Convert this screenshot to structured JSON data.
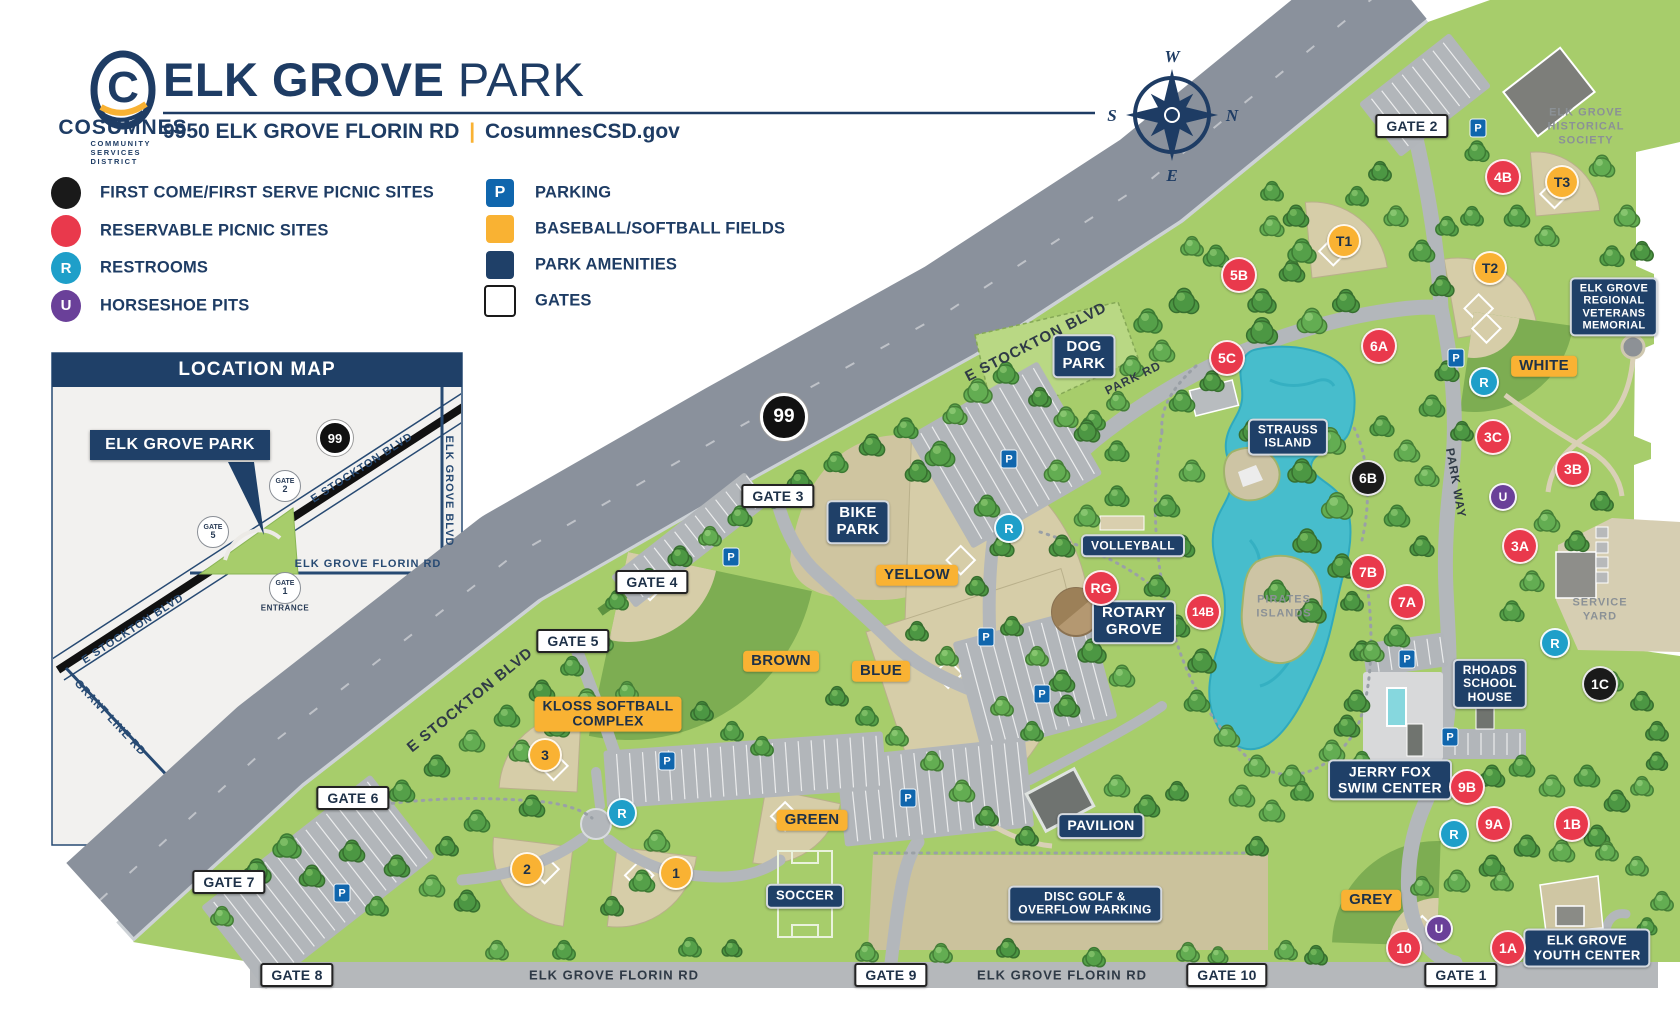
{
  "header": {
    "org": "COSUMNES",
    "org_sub": "COMMUNITY SERVICES DISTRICT",
    "logo_letter": "C",
    "title_bold": "ELK GROVE",
    "title_light": "PARK",
    "address": "9950 ELK GROVE FLORIN RD",
    "separator": "|",
    "website": "CosumnesCSD.gov"
  },
  "compass": {
    "top": "W",
    "right": "N",
    "bottom": "E",
    "left": "S"
  },
  "legend": {
    "left": [
      {
        "icon": "black-circle",
        "glyph": "",
        "label": "FIRST COME/FIRST SERVE PICNIC SITES"
      },
      {
        "icon": "red-circle",
        "glyph": "",
        "label": "RESERVABLE PICNIC SITES"
      },
      {
        "icon": "restroom-circle",
        "glyph": "R",
        "label": "RESTROOMS"
      },
      {
        "icon": "horseshoe-circle",
        "glyph": "U",
        "label": "HORSESHOE PITS"
      }
    ],
    "right": [
      {
        "icon": "parking-square",
        "glyph": "P",
        "label": "PARKING"
      },
      {
        "icon": "yellow-square",
        "glyph": "",
        "label": "BASEBALL/SOFTBALL FIELDS"
      },
      {
        "icon": "navy-square",
        "glyph": "",
        "label": "PARK AMENITIES"
      },
      {
        "icon": "white-square",
        "glyph": "",
        "label": "GATES"
      }
    ]
  },
  "location_map": {
    "title": "LOCATION MAP",
    "park_label": "ELK GROVE PARK",
    "highway": "99",
    "entrance": "ENTRANCE",
    "gates": [
      {
        "line1": "GATE",
        "line2": "2",
        "x": 285,
        "y": 486
      },
      {
        "line1": "GATE",
        "line2": "5",
        "x": 213,
        "y": 532
      },
      {
        "line1": "GATE",
        "line2": "1",
        "x": 285,
        "y": 588
      }
    ],
    "road_labels": [
      {
        "text": "E STOCKTON BLVD",
        "x": 362,
        "y": 468,
        "rot": -33,
        "fs": 11
      },
      {
        "text": "E STOCKTON BLVD",
        "x": 133,
        "y": 629,
        "rot": -33,
        "fs": 11
      },
      {
        "text": "ELK GROVE FLORIN RD",
        "x": 368,
        "y": 564,
        "rot": 0,
        "fs": 11
      },
      {
        "text": "ELK GROVE BLVD",
        "x": 449,
        "y": 491,
        "rot": 90,
        "fs": 11
      },
      {
        "text": "GRANT LINE RD",
        "x": 110,
        "y": 718,
        "rot": 47,
        "fs": 11
      }
    ]
  },
  "map": {
    "highway_badge": {
      "text": "99",
      "x": 784,
      "y": 417
    },
    "gates": [
      {
        "label": "GATE 1",
        "x": 1461,
        "y": 975
      },
      {
        "label": "GATE 2",
        "x": 1412,
        "y": 126
      },
      {
        "label": "GATE 3",
        "x": 778,
        "y": 496
      },
      {
        "label": "GATE 4",
        "x": 652,
        "y": 582
      },
      {
        "label": "GATE 5",
        "x": 573,
        "y": 641
      },
      {
        "label": "GATE 6",
        "x": 353,
        "y": 798
      },
      {
        "label": "GATE 7",
        "x": 229,
        "y": 882
      },
      {
        "label": "GATE 8",
        "x": 297,
        "y": 975
      },
      {
        "label": "GATE 9",
        "x": 891,
        "y": 975
      },
      {
        "label": "GATE 10",
        "x": 1227,
        "y": 975
      }
    ],
    "amenities": [
      {
        "id": "dog-park",
        "lines": [
          "DOG",
          "PARK"
        ],
        "x": 1084,
        "y": 356,
        "fs": 15
      },
      {
        "id": "bike-park",
        "lines": [
          "BIKE",
          "PARK"
        ],
        "x": 858,
        "y": 522,
        "fs": 15
      },
      {
        "id": "volleyball",
        "lines": [
          "VOLLEYBALL"
        ],
        "x": 1133,
        "y": 546,
        "fs": 12
      },
      {
        "id": "rotary-grove",
        "lines": [
          "ROTARY",
          "GROVE"
        ],
        "x": 1134,
        "y": 622,
        "fs": 15
      },
      {
        "id": "strauss-island",
        "lines": [
          "STRAUSS",
          "ISLAND"
        ],
        "x": 1288,
        "y": 437,
        "fs": 12
      },
      {
        "id": "pavilion",
        "lines": [
          "PAVILION"
        ],
        "x": 1101,
        "y": 826,
        "fs": 14
      },
      {
        "id": "disc-golf",
        "lines": [
          "DISC GOLF &",
          "OVERFLOW PARKING"
        ],
        "x": 1085,
        "y": 904,
        "fs": 12
      },
      {
        "id": "jerry-fox-swim-center",
        "lines": [
          "JERRY FOX",
          "SWIM CENTER"
        ],
        "x": 1390,
        "y": 780,
        "fs": 14
      },
      {
        "id": "rhoads-school-house",
        "lines": [
          "RHOADS",
          "SCHOOL",
          "HOUSE"
        ],
        "x": 1490,
        "y": 684,
        "fs": 12
      },
      {
        "id": "elk-grove-youth-center",
        "lines": [
          "ELK GROVE",
          "YOUTH CENTER"
        ],
        "x": 1587,
        "y": 948,
        "fs": 13
      },
      {
        "id": "veterans-memorial",
        "lines": [
          "ELK GROVE",
          "REGIONAL",
          "VETERANS",
          "MEMORIAL"
        ],
        "x": 1614,
        "y": 307,
        "fs": 11
      },
      {
        "id": "soccer",
        "lines": [
          "SOCCER"
        ],
        "x": 805,
        "y": 896,
        "fs": 13
      }
    ],
    "field_labels": [
      {
        "label": "WHITE",
        "x": 1544,
        "y": 366
      },
      {
        "label": "YELLOW",
        "x": 917,
        "y": 575
      },
      {
        "label": "BROWN",
        "x": 781,
        "y": 661
      },
      {
        "label": "BLUE",
        "x": 881,
        "y": 671
      },
      {
        "label": "GREEN",
        "x": 812,
        "y": 820
      },
      {
        "label": "GREY",
        "x": 1371,
        "y": 900
      }
    ],
    "kloss_label": {
      "lines": [
        "KLOSS SOFTBALL",
        "COMPLEX"
      ],
      "x": 608,
      "y": 714
    },
    "reservable_sites": [
      {
        "label": "4B",
        "x": 1503,
        "y": 177
      },
      {
        "label": "5B",
        "x": 1239,
        "y": 275
      },
      {
        "label": "6A",
        "x": 1379,
        "y": 346
      },
      {
        "label": "5C",
        "x": 1227,
        "y": 358
      },
      {
        "label": "3C",
        "x": 1493,
        "y": 437
      },
      {
        "label": "3B",
        "x": 1573,
        "y": 469
      },
      {
        "label": "3A",
        "x": 1520,
        "y": 546
      },
      {
        "label": "7B",
        "x": 1368,
        "y": 572
      },
      {
        "label": "RG",
        "x": 1101,
        "y": 588
      },
      {
        "label": "7A",
        "x": 1407,
        "y": 602
      },
      {
        "label": "14B",
        "x": 1203,
        "y": 612
      },
      {
        "label": "9B",
        "x": 1467,
        "y": 787
      },
      {
        "label": "9A",
        "x": 1494,
        "y": 824
      },
      {
        "label": "1B",
        "x": 1572,
        "y": 824
      },
      {
        "label": "10",
        "x": 1404,
        "y": 948
      },
      {
        "label": "1A",
        "x": 1508,
        "y": 948
      }
    ],
    "first_come_sites": [
      {
        "label": "6B",
        "x": 1368,
        "y": 478
      },
      {
        "label": "1C",
        "x": 1600,
        "y": 684
      }
    ],
    "field_markers": [
      {
        "label": "T3",
        "x": 1562,
        "y": 182
      },
      {
        "label": "T1",
        "x": 1344,
        "y": 241
      },
      {
        "label": "T2",
        "x": 1490,
        "y": 268
      },
      {
        "label": "3",
        "x": 545,
        "y": 755
      },
      {
        "label": "2",
        "x": 527,
        "y": 869
      },
      {
        "label": "1",
        "x": 676,
        "y": 873
      }
    ],
    "restrooms": [
      {
        "x": 1484,
        "y": 382
      },
      {
        "x": 1009,
        "y": 528
      },
      {
        "x": 622,
        "y": 813
      },
      {
        "x": 1555,
        "y": 643
      },
      {
        "x": 1454,
        "y": 834
      }
    ],
    "horseshoe_pits": [
      {
        "x": 1503,
        "y": 497
      },
      {
        "x": 1439,
        "y": 929
      }
    ],
    "parking": [
      {
        "x": 1478,
        "y": 128
      },
      {
        "x": 1456,
        "y": 358
      },
      {
        "x": 1009,
        "y": 459
      },
      {
        "x": 731,
        "y": 557
      },
      {
        "x": 986,
        "y": 637
      },
      {
        "x": 1042,
        "y": 694
      },
      {
        "x": 667,
        "y": 761
      },
      {
        "x": 342,
        "y": 893
      },
      {
        "x": 908,
        "y": 798
      },
      {
        "x": 1407,
        "y": 659
      },
      {
        "x": 1450,
        "y": 737
      }
    ],
    "road_labels": [
      {
        "text": "E STOCKTON BLVD",
        "x": 1036,
        "y": 342,
        "rot": -27,
        "fs": 15
      },
      {
        "text": "E STOCKTON BLVD",
        "x": 470,
        "y": 700,
        "rot": -39,
        "fs": 15
      },
      {
        "text": "PARK RD",
        "x": 1133,
        "y": 378,
        "rot": -26,
        "fs": 12
      },
      {
        "text": "PARK WAY",
        "x": 1456,
        "y": 483,
        "rot": 80,
        "fs": 12
      },
      {
        "text": "ELK GROVE FLORIN RD",
        "x": 614,
        "y": 975,
        "rot": 0,
        "fs": 13
      },
      {
        "text": "ELK GROVE FLORIN RD",
        "x": 1062,
        "y": 975,
        "rot": 0,
        "fs": 13
      }
    ],
    "annotations": [
      {
        "id": "historical-society",
        "lines": [
          "ELK GROVE",
          "HISTORICAL",
          "SOCIETY"
        ],
        "x": 1586,
        "y": 127,
        "fs": 11
      },
      {
        "id": "service-yard",
        "lines": [
          "SERVICE",
          "YARD"
        ],
        "x": 1600,
        "y": 610,
        "fs": 11
      },
      {
        "id": "pirates-islands",
        "lines": [
          "PIRATES",
          "ISLANDS"
        ],
        "x": 1284,
        "y": 607,
        "fs": 11
      }
    ]
  },
  "colors": {
    "navy": "#1f4068",
    "navy_text": "#1e3c64",
    "yellow": "#f9b233",
    "red": "#e9394c",
    "teal": "#1e9fc9",
    "purple": "#6a4099",
    "parking_blue": "#1066ad",
    "park_green": "#a7cd6b",
    "road_grey": "#8a919c",
    "lake": "#47bdcc"
  }
}
